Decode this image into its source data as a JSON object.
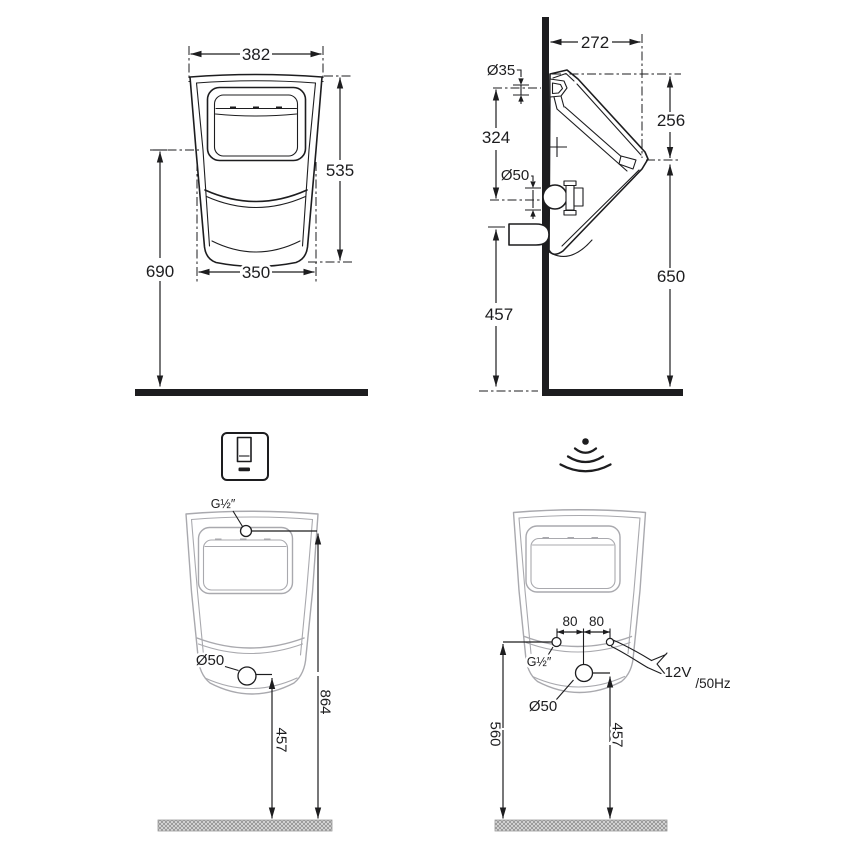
{
  "views": {
    "front": {
      "top_width": "382",
      "height": "535",
      "bottom_width": "350",
      "rim_height": "690"
    },
    "side": {
      "depth": "272",
      "inlet_diameter": "Ø35",
      "inlet_to_outlet": "324",
      "top_to_spout": "256",
      "outlet_diameter": "Ø50",
      "outlet_height": "457",
      "spout_height": "650"
    },
    "manual_flush": {
      "inlet_thread": "G½″",
      "outlet_diameter": "Ø50",
      "outlet_height": "457",
      "inlet_height": "864"
    },
    "sensor_flush": {
      "offset_left": "80",
      "offset_right": "80",
      "inlet_thread": "G½″",
      "outlet_diameter": "Ø50",
      "outlet_height": "457",
      "inlet_height": "560",
      "power": "12V",
      "frequency": "/50Hz"
    }
  },
  "icons": {
    "manual": "flush-plate-icon",
    "sensor": "wireless-signal-icon"
  },
  "colors": {
    "line": "#1d1d1f",
    "body_outline_gray": "#a9a9ae",
    "background": "#ffffff"
  }
}
